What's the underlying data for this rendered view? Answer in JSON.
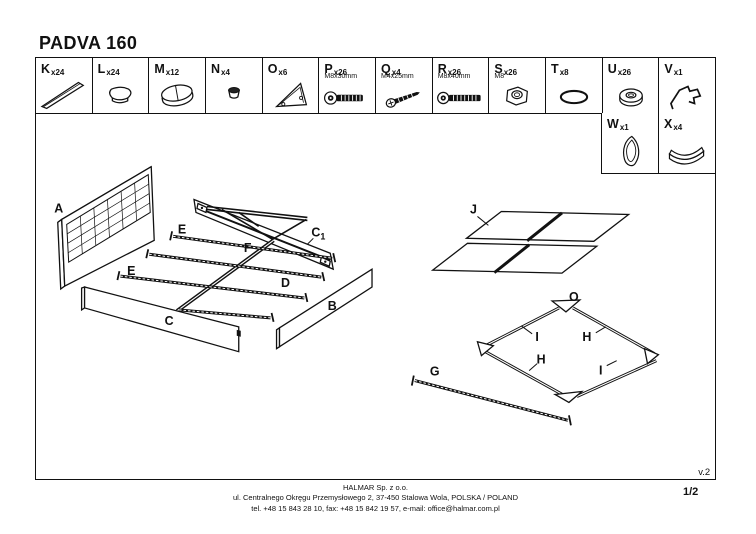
{
  "title": "PADVA 160",
  "page": "1/2",
  "version": "v.2",
  "parts": [
    {
      "id": "K",
      "count": "x24",
      "spec": ""
    },
    {
      "id": "L",
      "count": "x24",
      "spec": ""
    },
    {
      "id": "M",
      "count": "x12",
      "spec": ""
    },
    {
      "id": "N",
      "count": "x4",
      "spec": ""
    },
    {
      "id": "O",
      "count": "x6",
      "spec": ""
    },
    {
      "id": "P",
      "count": "x26",
      "spec": "M8x30mm"
    },
    {
      "id": "Q",
      "count": "x4",
      "spec": "M4x25mm"
    },
    {
      "id": "R",
      "count": "x26",
      "spec": "M8x40mm"
    },
    {
      "id": "S",
      "count": "x26",
      "spec": "M8"
    },
    {
      "id": "T",
      "count": "x8",
      "spec": ""
    },
    {
      "id": "U",
      "count": "x26",
      "spec": ""
    },
    {
      "id": "V",
      "count": "x1",
      "spec": ""
    },
    {
      "id": "W",
      "count": "x1",
      "spec": ""
    },
    {
      "id": "X",
      "count": "x4",
      "spec": ""
    }
  ],
  "labels": {
    "a": "A",
    "b": "B",
    "c": "C",
    "c1_main": "C",
    "c1_sub": "1",
    "d": "D",
    "e": "E",
    "f": "F",
    "g": "G",
    "h": "H",
    "i": "I",
    "j": "J",
    "o": "O"
  },
  "footer": {
    "company": "HALMAR Sp. z o.o.",
    "address": "ul. Centralnego Okręgu Przemysłowego 2, 37-450 Stalowa Wola, POLSKA / POLAND",
    "contact": "tel. +48 15 843 28 10, fax: +48 15 842 19 57, e-mail: office@halmar.com.pl"
  }
}
